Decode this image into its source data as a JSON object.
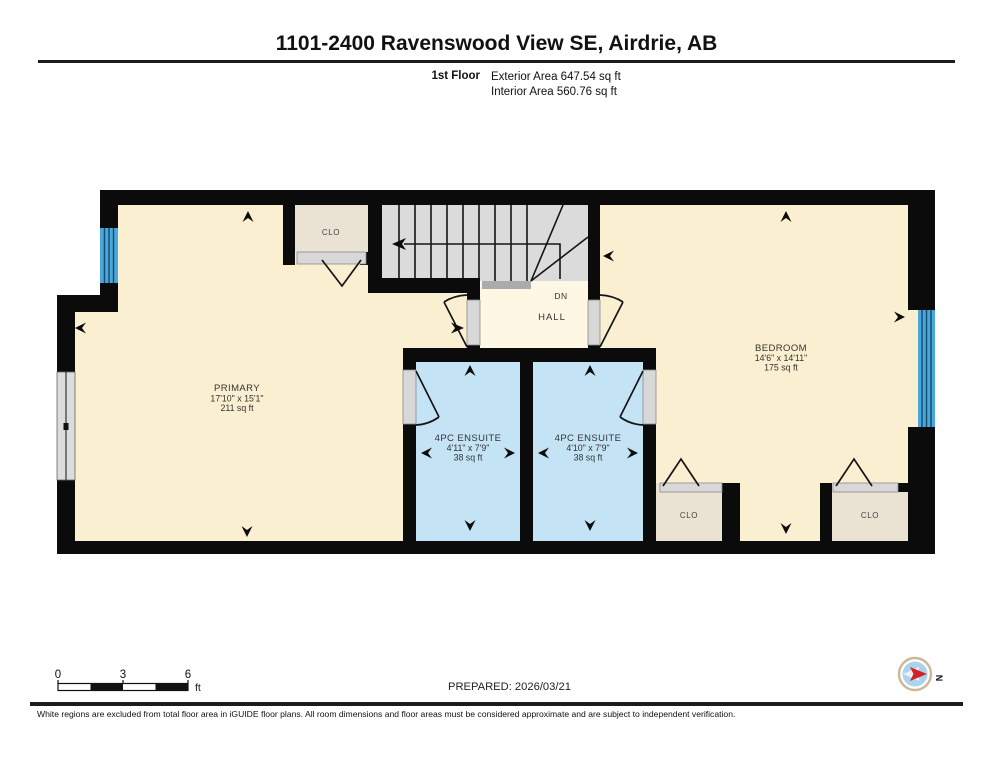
{
  "header": {
    "title": "1101-2400 Ravenswood View SE, Airdrie, AB",
    "floor_label": "1st Floor",
    "exterior_area": "Exterior Area 647.54 sq ft",
    "interior_area": "Interior Area 560.76 sq ft"
  },
  "rooms": {
    "primary": {
      "name": "PRIMARY",
      "dims": "17'10\" x 15'1\"",
      "area": "211 sq ft"
    },
    "bedroom": {
      "name": "BEDROOM",
      "dims": "14'6\" x 14'11\"",
      "area": "175 sq ft"
    },
    "ensuite_left": {
      "name": "4PC ENSUITE",
      "dims": "4'11\" x 7'9\"",
      "area": "38 sq ft"
    },
    "ensuite_right": {
      "name": "4PC ENSUITE",
      "dims": "4'10\" x 7'9\"",
      "area": "38 sq ft"
    },
    "hall": {
      "name": "HALL",
      "stairs_direction": "DN"
    },
    "closet_top": {
      "name": "CLO"
    },
    "closet_bottom_left": {
      "name": "CLO"
    },
    "closet_bottom_right": {
      "name": "CLO"
    }
  },
  "scale_bar": {
    "tick0": "0",
    "tick3": "3",
    "tick6": "6",
    "unit": "ft"
  },
  "footer": {
    "prepared": "PREPARED: 2026/03/21",
    "disclaimer": "White regions are excluded from total floor area in iGUIDE floor plans. All room dimensions and floor areas must be considered approximate and are subject to independent verification.",
    "compass_label": "N"
  },
  "colors": {
    "wall_black": "#0b0b0b",
    "floor_cream": "#FBEFD1",
    "hall_cream": "#FDF7E3",
    "ensuite_blue": "#C4E4F6",
    "closet_tan": "#EAE3D4",
    "stairs_gray": "#DBDBDB",
    "window_blue": "#4AA7DB",
    "compass_red": "#D42127",
    "compass_ring": "#CBB795",
    "compass_face": "#A9D4EC"
  }
}
